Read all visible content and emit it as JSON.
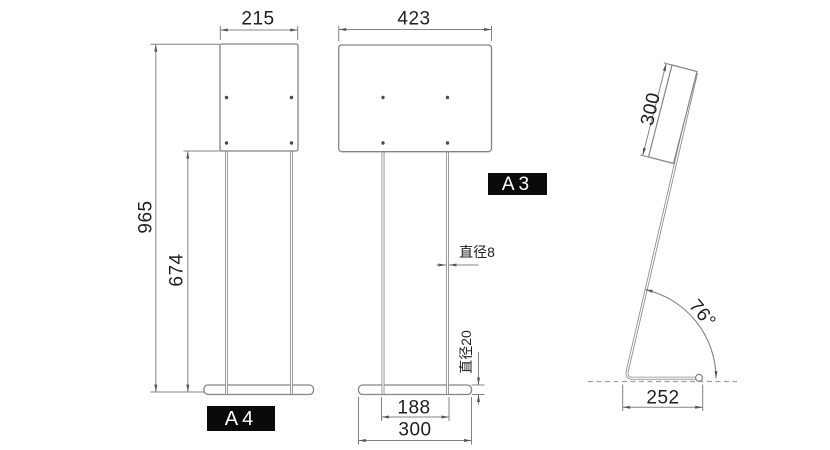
{
  "colors": {
    "line": "#848484",
    "arrow": "#555555",
    "text": "#1f1f1f",
    "badge_bg": "#0a0a0a",
    "badge_text": "#ffffff"
  },
  "views": {
    "a4_front": {
      "badge": "A4",
      "width_mm": "215",
      "total_height_mm": "965",
      "pole_height_mm": "674"
    },
    "a3_front": {
      "badge": "A3",
      "width_mm": "423",
      "pole_diameter_label": "直径8",
      "base_tube_diameter_label": "直径20",
      "leg_span_mm": "188",
      "base_width_mm": "300"
    },
    "side": {
      "panel_length_mm": "300",
      "tilt_angle": "76°",
      "base_depth_mm": "252"
    }
  }
}
